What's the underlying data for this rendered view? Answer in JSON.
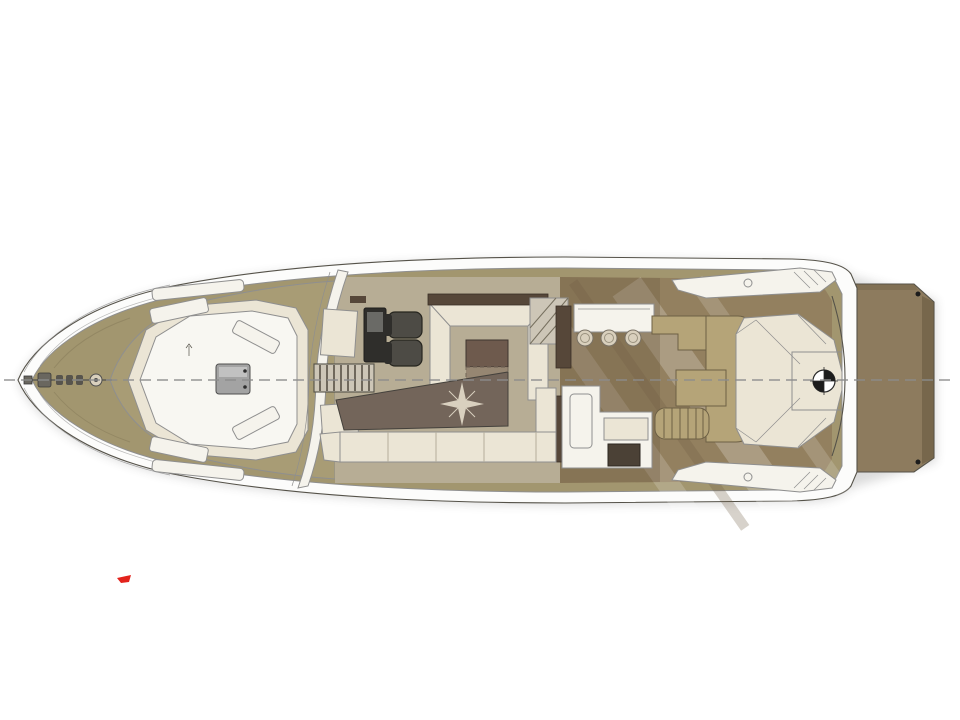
{
  "canvas": {
    "width": 960,
    "height": 720,
    "background": "#ffffff"
  },
  "colors": {
    "background": "#ffffff",
    "hull_white": "#fcfcfb",
    "gunwale_white": "#f5f3ec",
    "deck_khaki": "#a2966f",
    "foredeck_khaki": "#a89c75",
    "salon_base": "#b7ad95",
    "cockpit_floor": "#93805f",
    "cockpit_floor_dark": "#6f5e46",
    "platform_brown": "#8d7b5e",
    "platform_edge": "#66573e",
    "cream_cushion": "#ebe5d5",
    "white_soft": "#f5f3ec",
    "inner_panel": "#f8f7f2",
    "dark_floor": "#73655a",
    "compass_star": "#d9d0bf",
    "table_wood": "#6e5a4d",
    "table_wood_light": "#93826f",
    "metal_gray": "#a3a3a3",
    "seat_dark": "#4d4b45",
    "seat_edge": "#2f2e2b",
    "bulkhead_wood": "#564739",
    "stair_tread": "#cdc6b7",
    "khaki_settee": "#b5a478",
    "stool": "#d9d0bd",
    "appliance_dark": "#4b4136",
    "windlass_metal": "#6a675f",
    "centerline_gray": "#8c8c8c",
    "shadow_gray": "#3a3a3a",
    "marker_black": "#1c1c1c",
    "red_accent": "#e3231c"
  }
}
